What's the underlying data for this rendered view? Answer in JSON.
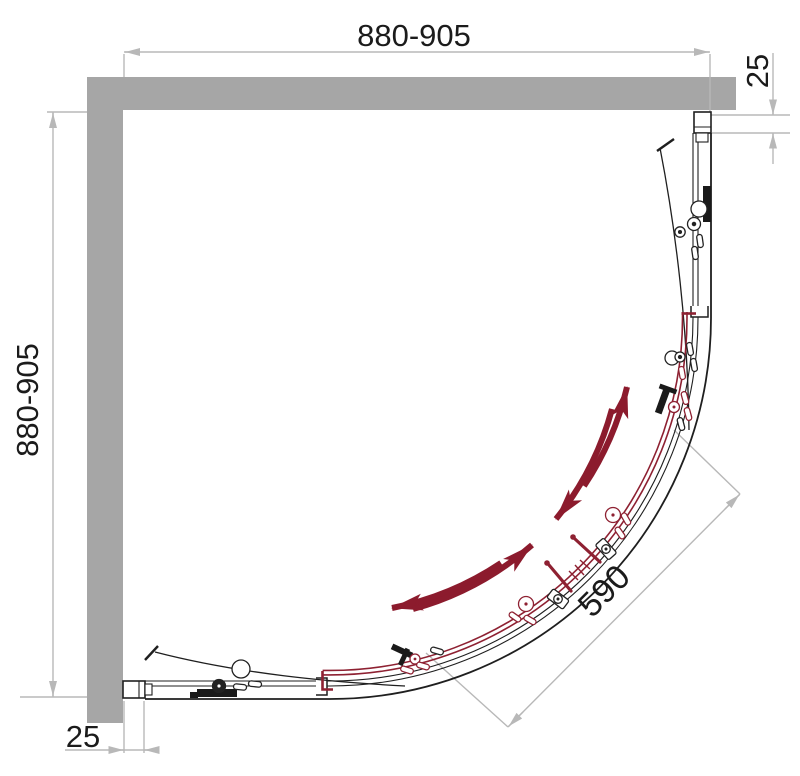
{
  "diagram": {
    "title": "quadrant-shower-enclosure-plan-technical-drawing",
    "dims": {
      "top": "880-905",
      "left": "880-905",
      "right": "25",
      "bottom": "25",
      "diagonal": "590"
    },
    "colors": {
      "wall_gray": "#a6a6a6",
      "dimension_gray": "#b8b8b8",
      "line_black": "#1f1f1f",
      "door_red": "#8e2132",
      "arrow_red": "#8c1b2d",
      "text": "#1b1b1b",
      "background": "#ffffff"
    }
  }
}
